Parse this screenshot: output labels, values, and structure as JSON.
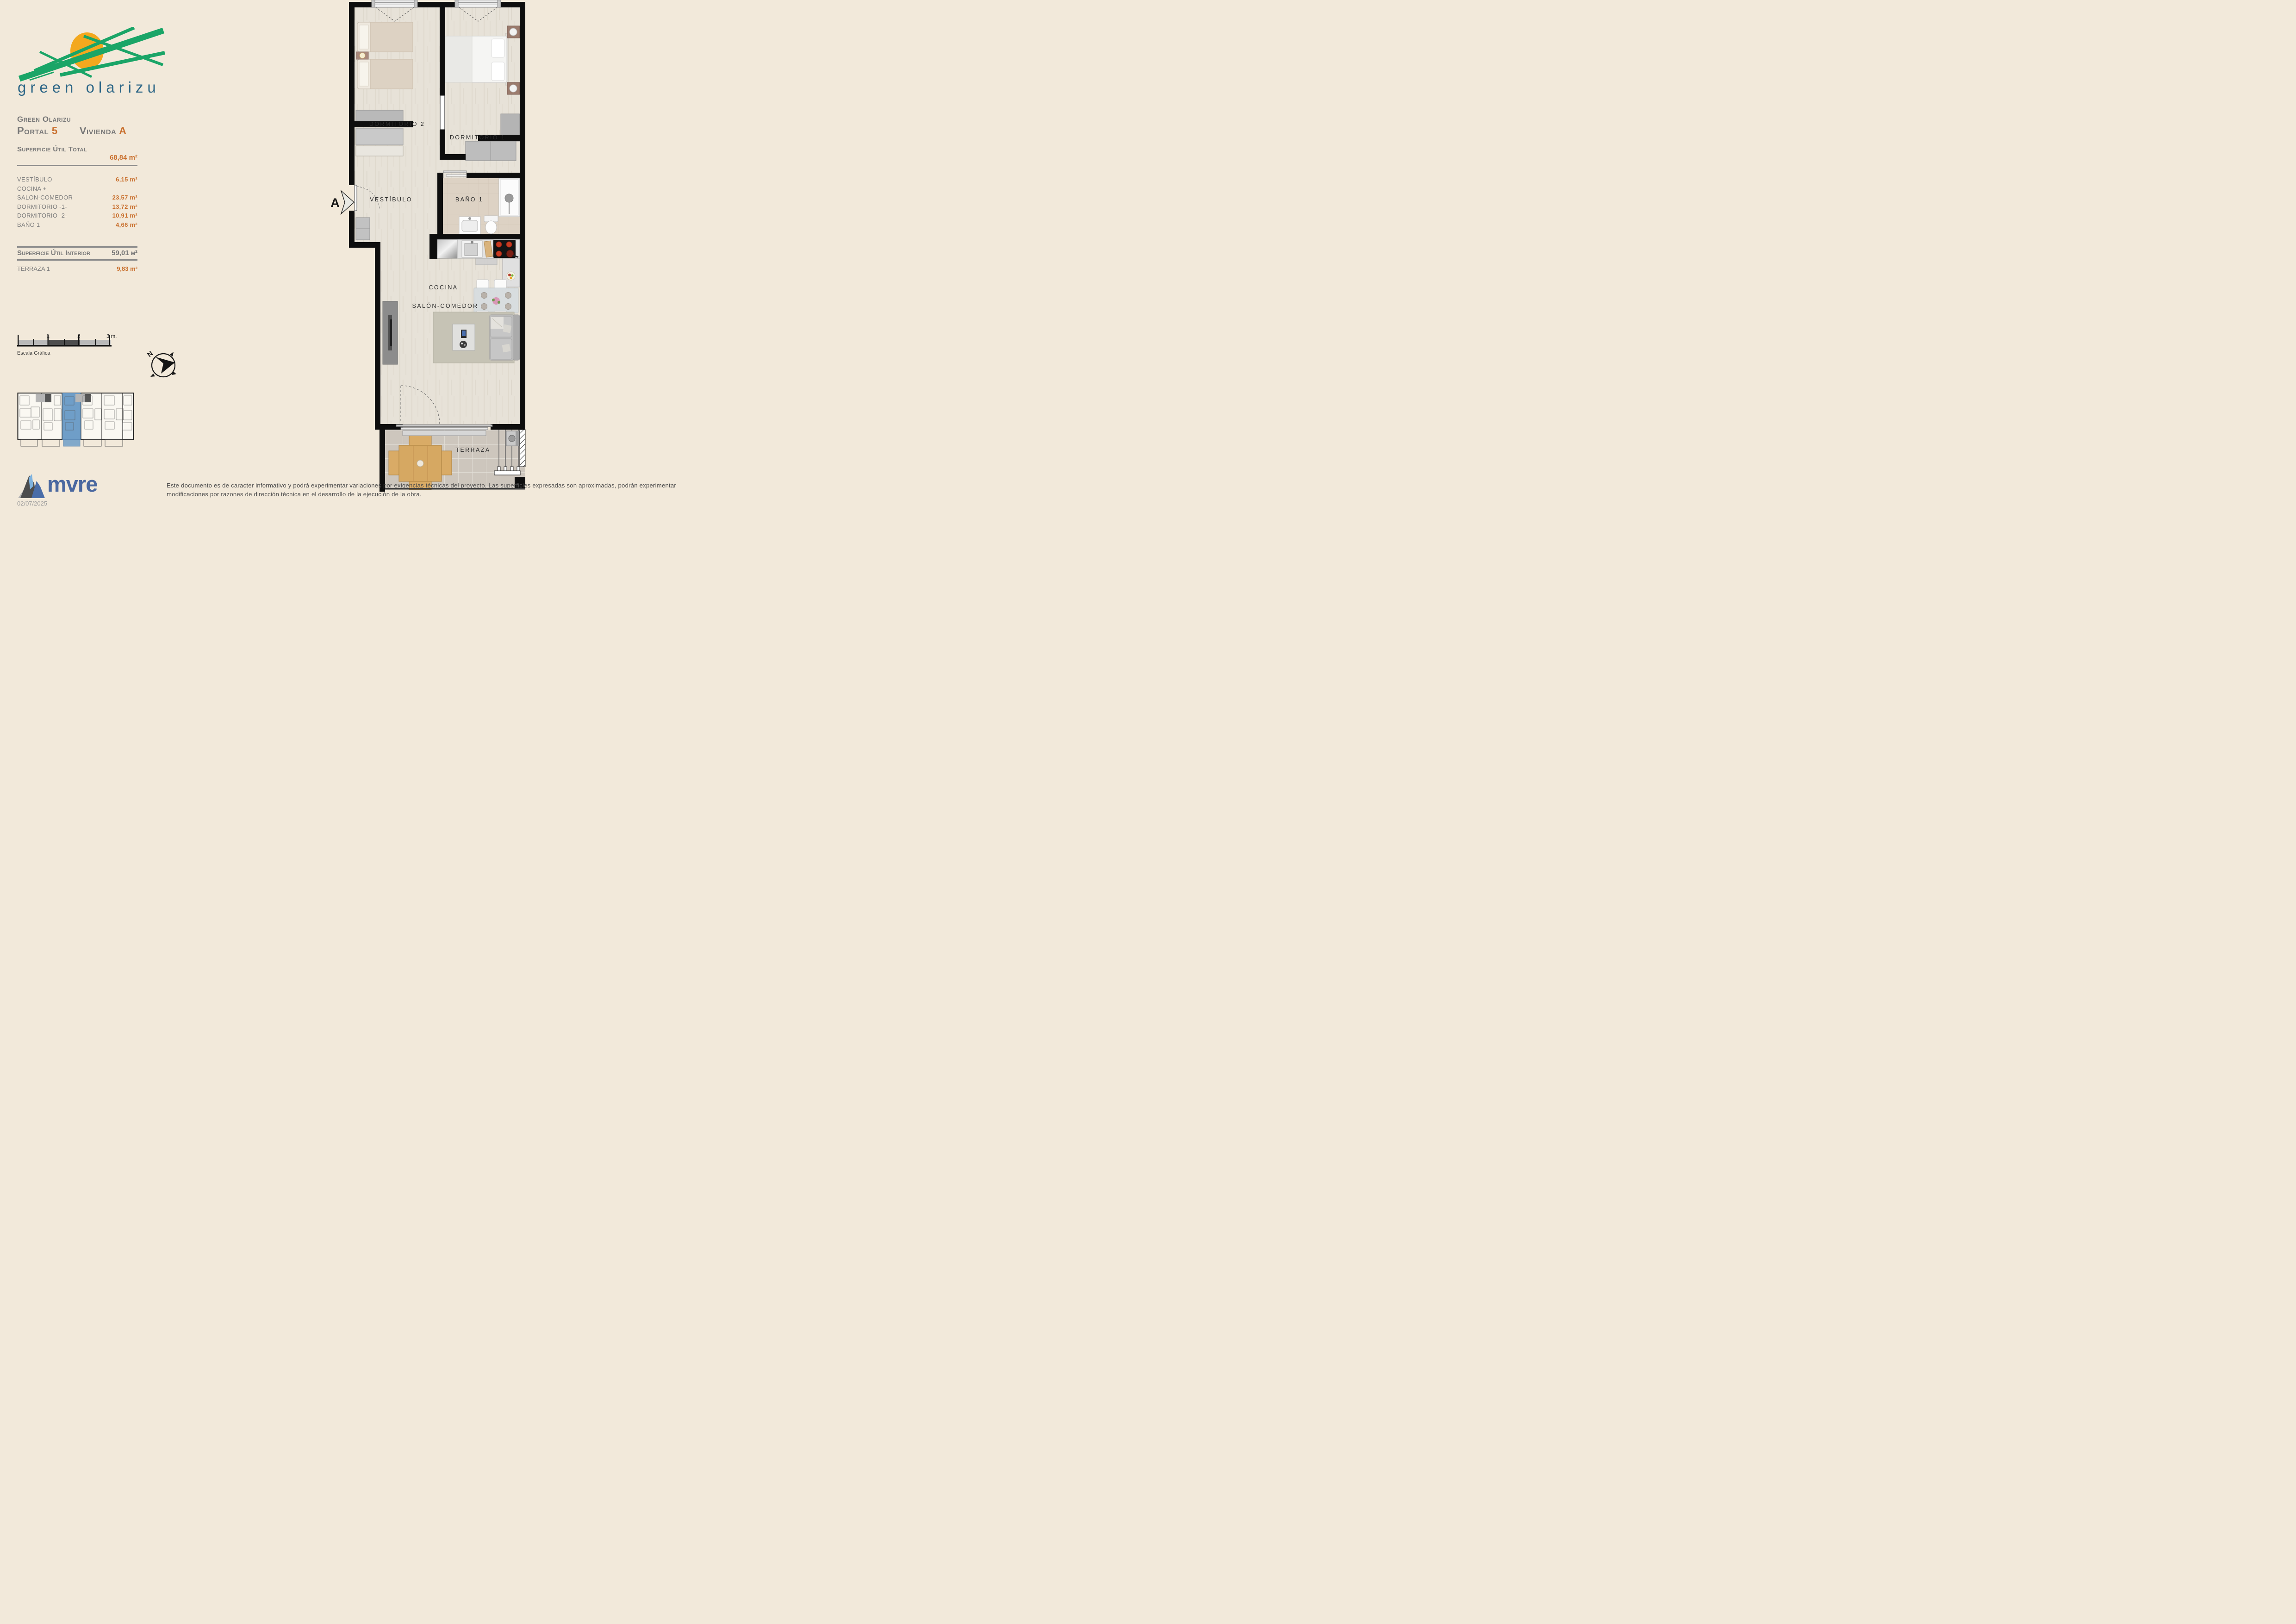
{
  "logo": {
    "brand": "green olarizu"
  },
  "sidebar": {
    "project": "Green Olarizu",
    "portal_label": "Portal",
    "portal_value": "5",
    "vivienda_label": "Vivienda",
    "vivienda_value": "A",
    "total_label": "Superficie Útil Total",
    "total_value": "68,84 m²",
    "rooms": [
      {
        "label": "VESTÍBULO",
        "value": "6,15 m²"
      },
      {
        "label": "COCINA +",
        "value": ""
      },
      {
        "label": "SALON-COMEDOR",
        "value": "23,57 m²"
      },
      {
        "label": "DORMITORIO -1-",
        "value": "13,72 m²"
      },
      {
        "label": "DORMITORIO -2-",
        "value": "10,91 m²"
      },
      {
        "label": "BAÑO 1",
        "value": "4,66 m²"
      }
    ],
    "interior_label": "Superficie Útil Interior",
    "interior_value": "59,01 m²",
    "terrace_label": "TERRAZA 1",
    "terrace_value": "9,83 m²",
    "scale": {
      "t1": "1",
      "t2": "2",
      "t3": "3 m.",
      "caption": "Escala Gráfica"
    },
    "compass_n": "N"
  },
  "plan": {
    "labels": {
      "dorm2": "DORMITORIO 2",
      "dorm1": "DORMITORIO 1",
      "vestibulo": "VESTÍBULO",
      "bano": "BAÑO 1",
      "cocina": "COCINA",
      "salon": "SALÓN-COMEDOR",
      "terraza": "TERRAZA"
    },
    "section_marker": "A"
  },
  "footer": {
    "brand": "mvre",
    "date": "02/07/2025",
    "disclaimer": "Este documento es de caracter informativo y podrá experimentar variaciones por exigencias técnicas del proyecto. Las superficies expresadas son aproximadas, podrán experimentar modificaciones por razones de dirección técnica en el desarrollo de la ejecución de la obra."
  },
  "colors": {
    "accent_orange": "#c9702e",
    "text_gray": "#7a7a7a",
    "brand_teal": "#2e6787",
    "logo_green": "#1aa567",
    "logo_sun": "#f3a81e",
    "mvre_blue": "#4a68a0",
    "highlight_blue": "#6f9ec8",
    "wall_black": "#0e0e0e"
  }
}
